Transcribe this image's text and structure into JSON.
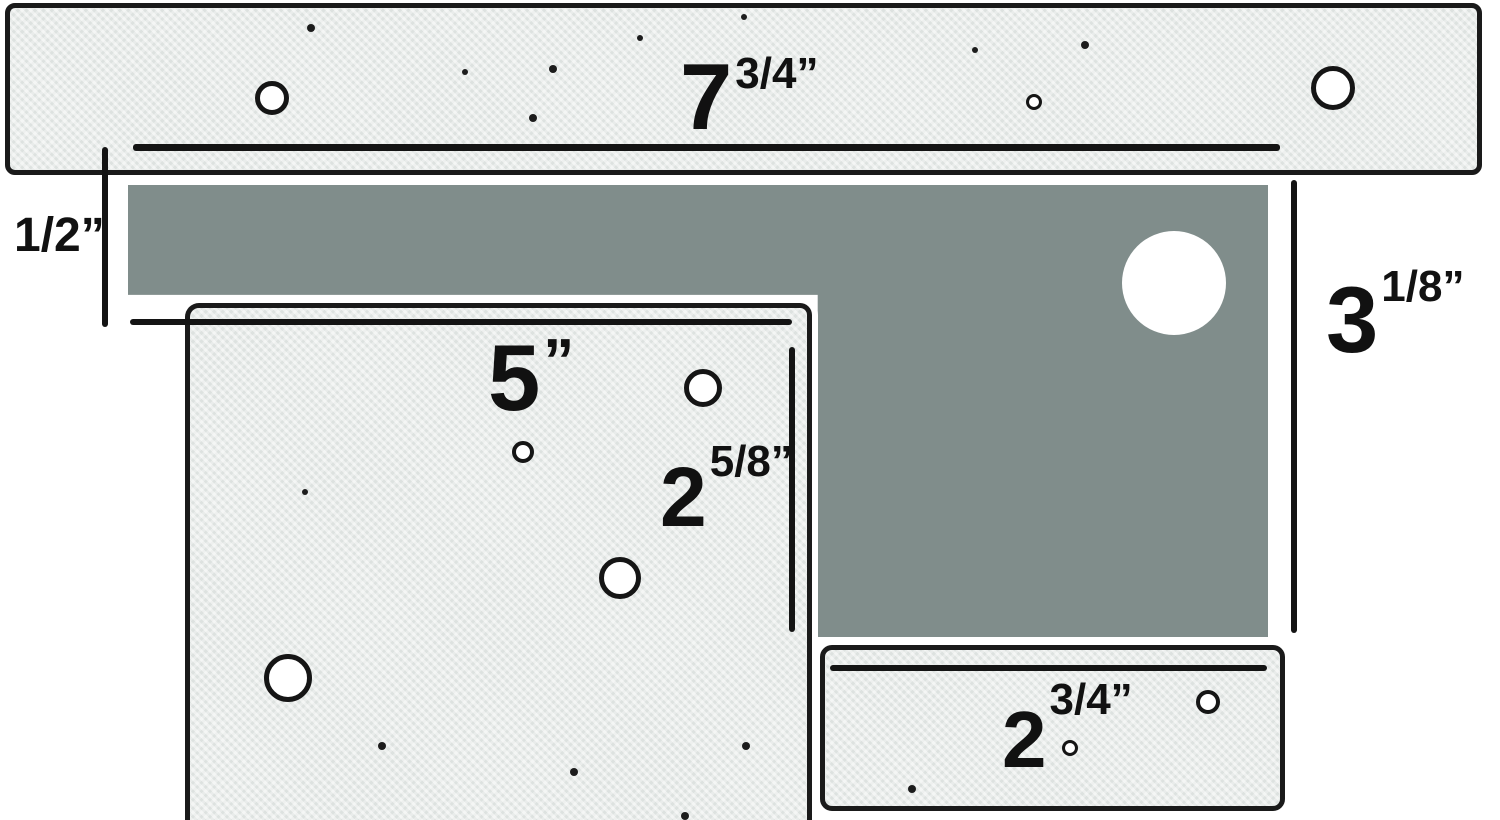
{
  "diagram": {
    "title": "bracket-plate-dimension-diagram",
    "colors": {
      "plate_fill": "#e6eae8",
      "plate_border": "#1a1a1a",
      "dark_panel": "#808d8b",
      "dim_line": "#141414",
      "text_color": "#111111",
      "page_bg": "#ffffff"
    },
    "dimensions": {
      "top_width": {
        "value": "7",
        "fraction": "3/4”"
      },
      "top_offset": {
        "value": "1/2”"
      },
      "plate_width": {
        "value": "5",
        "fraction": "”"
      },
      "plate_inner_height": {
        "value": "2",
        "fraction": "5/8”"
      },
      "side_height": {
        "value": "3",
        "fraction": "1/8”"
      },
      "bottom_plate_width": {
        "value": "2",
        "fraction": "3/4”"
      }
    },
    "holes": [
      {
        "x": 272,
        "y": 98,
        "r": 17,
        "kind": "ring"
      },
      {
        "x": 1034,
        "y": 102,
        "r": 8,
        "kind": "ring"
      },
      {
        "x": 1333,
        "y": 88,
        "r": 22,
        "kind": "ring"
      },
      {
        "x": 311,
        "y": 28,
        "r": 4,
        "kind": "dot"
      },
      {
        "x": 465,
        "y": 72,
        "r": 3,
        "kind": "dot"
      },
      {
        "x": 553,
        "y": 69,
        "r": 4,
        "kind": "dot"
      },
      {
        "x": 533,
        "y": 118,
        "r": 4,
        "kind": "dot"
      },
      {
        "x": 640,
        "y": 38,
        "r": 3,
        "kind": "dot"
      },
      {
        "x": 744,
        "y": 17,
        "r": 3,
        "kind": "dot"
      },
      {
        "x": 975,
        "y": 50,
        "r": 3,
        "kind": "dot"
      },
      {
        "x": 1085,
        "y": 45,
        "r": 4,
        "kind": "dot"
      },
      {
        "x": 1174,
        "y": 283,
        "r": 52,
        "kind": "white"
      },
      {
        "x": 703,
        "y": 388,
        "r": 19,
        "kind": "ring"
      },
      {
        "x": 523,
        "y": 452,
        "r": 11,
        "kind": "ring"
      },
      {
        "x": 620,
        "y": 578,
        "r": 21,
        "kind": "ring"
      },
      {
        "x": 288,
        "y": 678,
        "r": 24,
        "kind": "ring"
      },
      {
        "x": 305,
        "y": 492,
        "r": 3,
        "kind": "dot"
      },
      {
        "x": 382,
        "y": 746,
        "r": 4,
        "kind": "dot"
      },
      {
        "x": 574,
        "y": 772,
        "r": 4,
        "kind": "dot"
      },
      {
        "x": 746,
        "y": 746,
        "r": 4,
        "kind": "dot"
      },
      {
        "x": 685,
        "y": 816,
        "r": 4,
        "kind": "dot"
      },
      {
        "x": 1208,
        "y": 702,
        "r": 12,
        "kind": "ring"
      },
      {
        "x": 1070,
        "y": 748,
        "r": 8,
        "kind": "ring"
      },
      {
        "x": 912,
        "y": 789,
        "r": 4,
        "kind": "dot"
      }
    ]
  }
}
